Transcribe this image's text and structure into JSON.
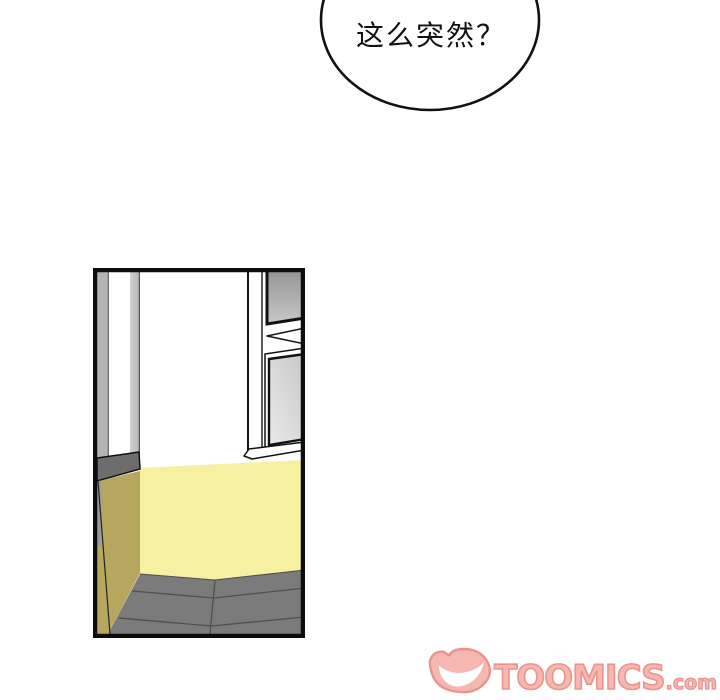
{
  "bubble": {
    "text": "这么突然？",
    "stroke": "#111111",
    "fill": "#ffffff"
  },
  "panel": {
    "border": "#0d0d0d",
    "colors": {
      "wall_white": "#ffffff",
      "wainscot_yellow": "#f5f1a0",
      "cabinet_khaki": "#b7a65e",
      "floor_gray": "#7b7b7b",
      "grout_dark": "#4f4f4f",
      "doorframe_gray": "#b4b4b4",
      "doorframe_light": "#d0d0d0",
      "counter_top_gray": "#6d6d6d",
      "sliver_gray": "#9b9b9b",
      "line_dark": "#161616",
      "glass_dark": "#8f8f8f",
      "glass_mid": "#c8c8c8",
      "glass_light": "#e9e9e9"
    }
  },
  "watermark": {
    "brand": "TOOMICS",
    "suffix": ".com",
    "fill": "#f6aba4",
    "outline": "#e8827a",
    "icon": "toomics-devil-icon"
  }
}
